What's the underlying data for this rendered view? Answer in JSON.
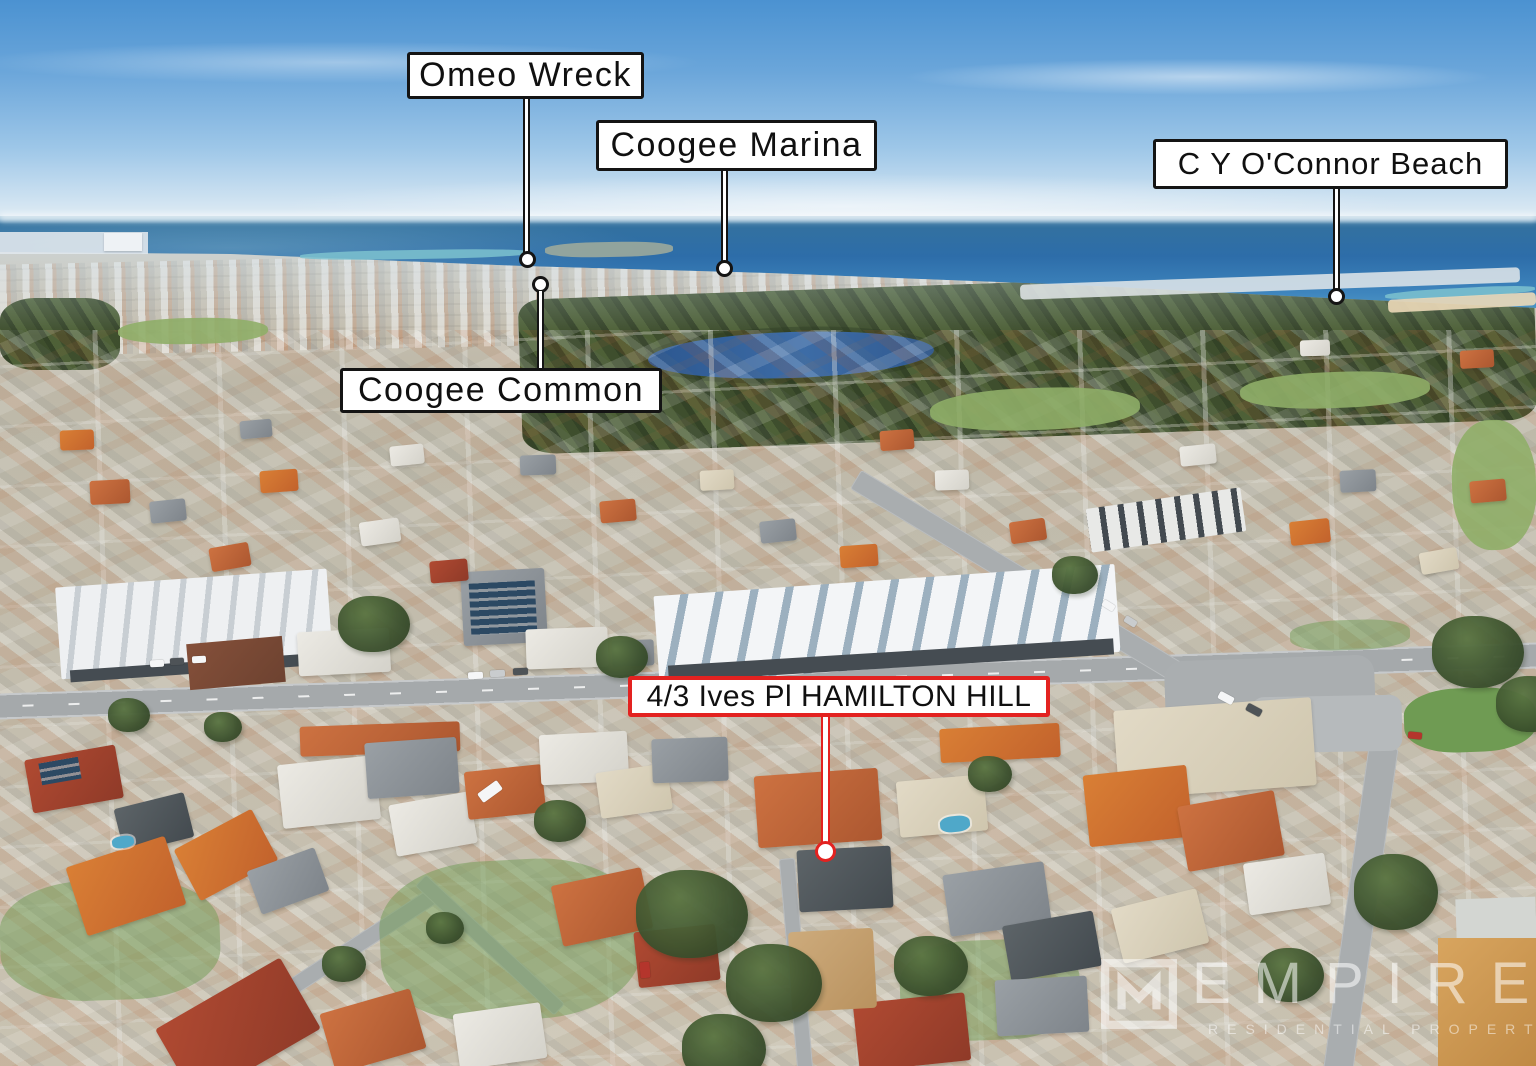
{
  "scene": {
    "type": "aerial-drone-photo",
    "description": "Aerial photo of a coastal suburb: blue sky, Indian Ocean horizon, bushland with a lake, dense suburb with orange and grey roofs, commercial strip along a main road",
    "palette": {
      "sky": "#5b9ed8",
      "ocean": "#2e74b0",
      "bushland": "#4a5a37",
      "lake": "#31619b",
      "suburb": "#c3bcae",
      "road": "#a9adb0",
      "callout_black": "#141414",
      "callout_red": "#e32220",
      "callout_fill": "#ffffff",
      "watermark_white": "rgba(255,255,255,0.55)"
    }
  },
  "callouts": {
    "omeo_wreck": {
      "label": "Omeo Wreck"
    },
    "coogee_marina": {
      "label": "Coogee Marina"
    },
    "cy_oconnor_beach": {
      "label": "C Y O'Connor Beach"
    },
    "coogee_common": {
      "label": "Coogee Common"
    },
    "property": {
      "label": "4/3 Ives Pl HAMILTON HILL"
    }
  },
  "watermark": {
    "brand": "EMPIRE",
    "tagline": "RESIDENTIAL PROPERTY"
  }
}
